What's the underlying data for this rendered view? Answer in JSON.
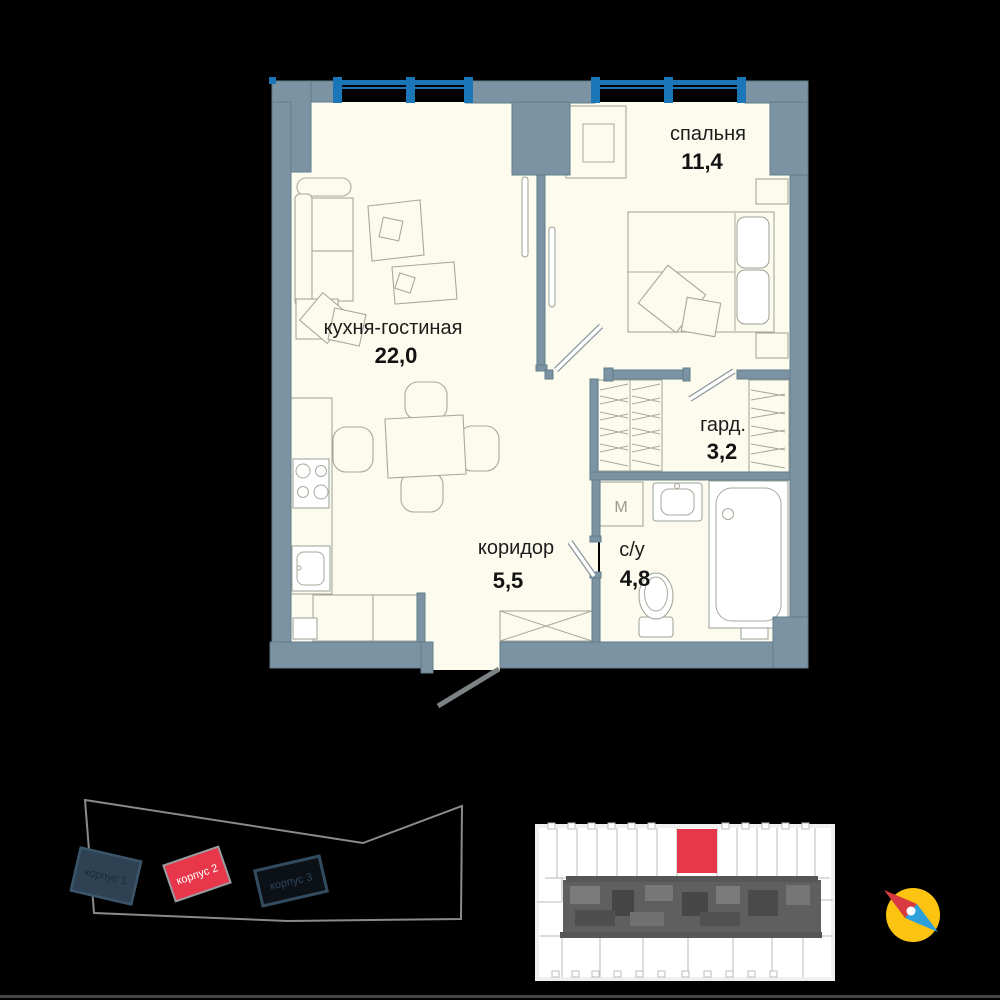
{
  "page": {
    "background": "#000000"
  },
  "floor_plan": {
    "rooms": [
      {
        "name": "спальня",
        "area": "11,4"
      },
      {
        "name": "кухня-гостиная",
        "area": "22,0"
      },
      {
        "name": "гард.",
        "area": "3,2"
      },
      {
        "name": "коридор",
        "area": "5,5"
      },
      {
        "name": "с/у",
        "area": "4,8"
      }
    ],
    "washer_symbol": "M",
    "colors": {
      "wall": "#7b93a3",
      "floor": "#fcfbee",
      "window": "#1b76b8",
      "furniture_line": "#a8a89c",
      "label_text": "#1c1c1c"
    }
  },
  "site_plan": {
    "buildings": [
      {
        "label": "корпус 1",
        "highlighted": false
      },
      {
        "label": "корпус 2",
        "highlighted": true
      },
      {
        "label": "корпус 3",
        "highlighted": false
      }
    ],
    "highlight_color": "#e8374b"
  },
  "floor_key": {
    "highlight_color": "#e8374b"
  },
  "compass": {
    "circle_color": "#fcc411",
    "north_color": "#d93a40",
    "south_color": "#2da0dc"
  }
}
